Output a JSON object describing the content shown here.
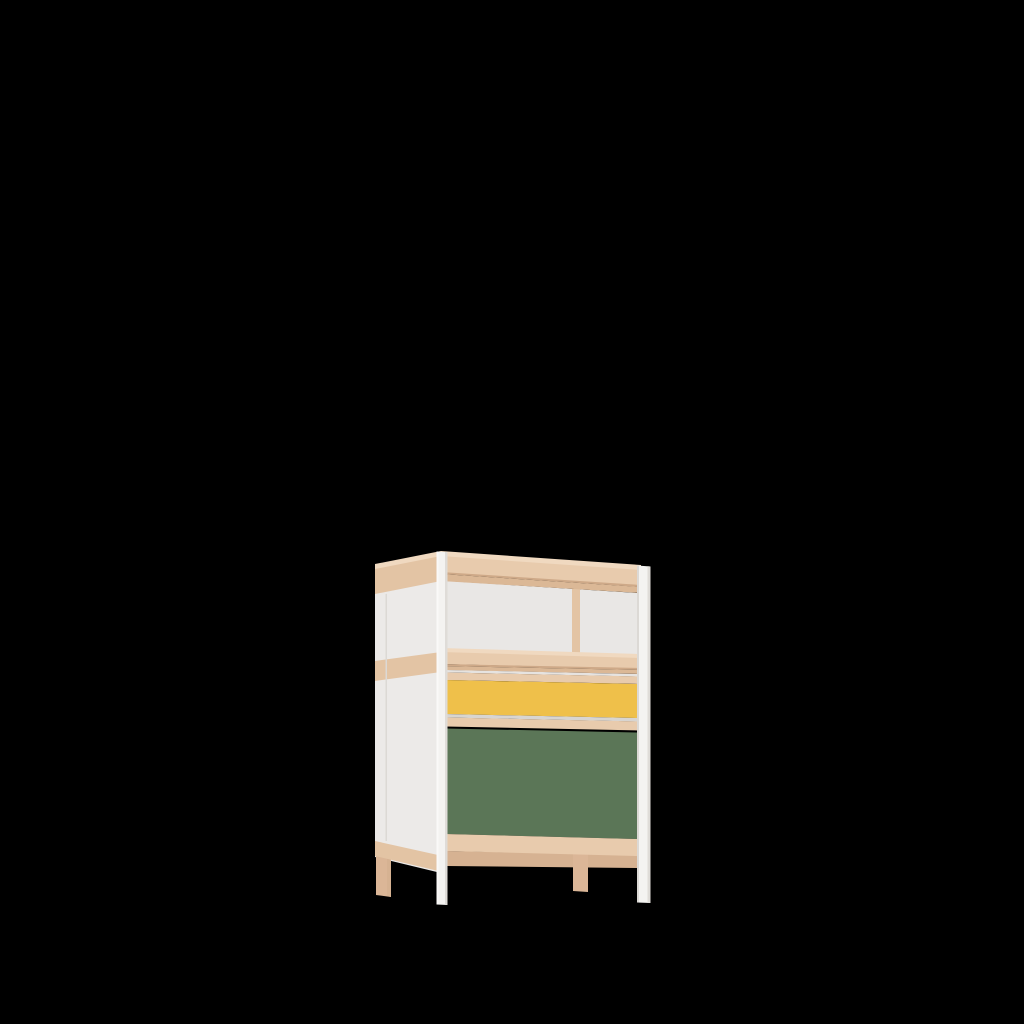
{
  "scene": {
    "description": "3D product render of a small storage cabinet on a black background, positioned lower-center",
    "product": {
      "kind": "storage-cabinet",
      "features": [
        "open top shelf compartment with vertical wood divider",
        "yellow drawer front",
        "green drawer front",
        "white lacquered front posts and side panel",
        "pale wood top, rails and back legs"
      ]
    },
    "canvas": {
      "width": 1024,
      "height": 1024
    }
  },
  "colors": {
    "background": "#000000",
    "wood_top": "#F0D9C0",
    "wood_face": "#E8CBAD",
    "wood_side": "#E3C4A4",
    "wood_seam": "#CEA988",
    "wood_under": "#DBB896",
    "wood_under_dark": "#D6B292",
    "wood_leg": "#DBB697",
    "panel_white": "#E9E7E5",
    "panel_side": "#ECEAE8",
    "post_white": "#F4F3F1",
    "post_highlight": "#FAF9F8",
    "post_shadow": "#DFDCD8",
    "contact_shadow": "#DCD9D5",
    "gap_light": "#D8D5D1",
    "shelf_gap_highlight": "#E6E3E0",
    "drawer_yellow": "#EFC04A",
    "door_green": "#5B7657"
  }
}
